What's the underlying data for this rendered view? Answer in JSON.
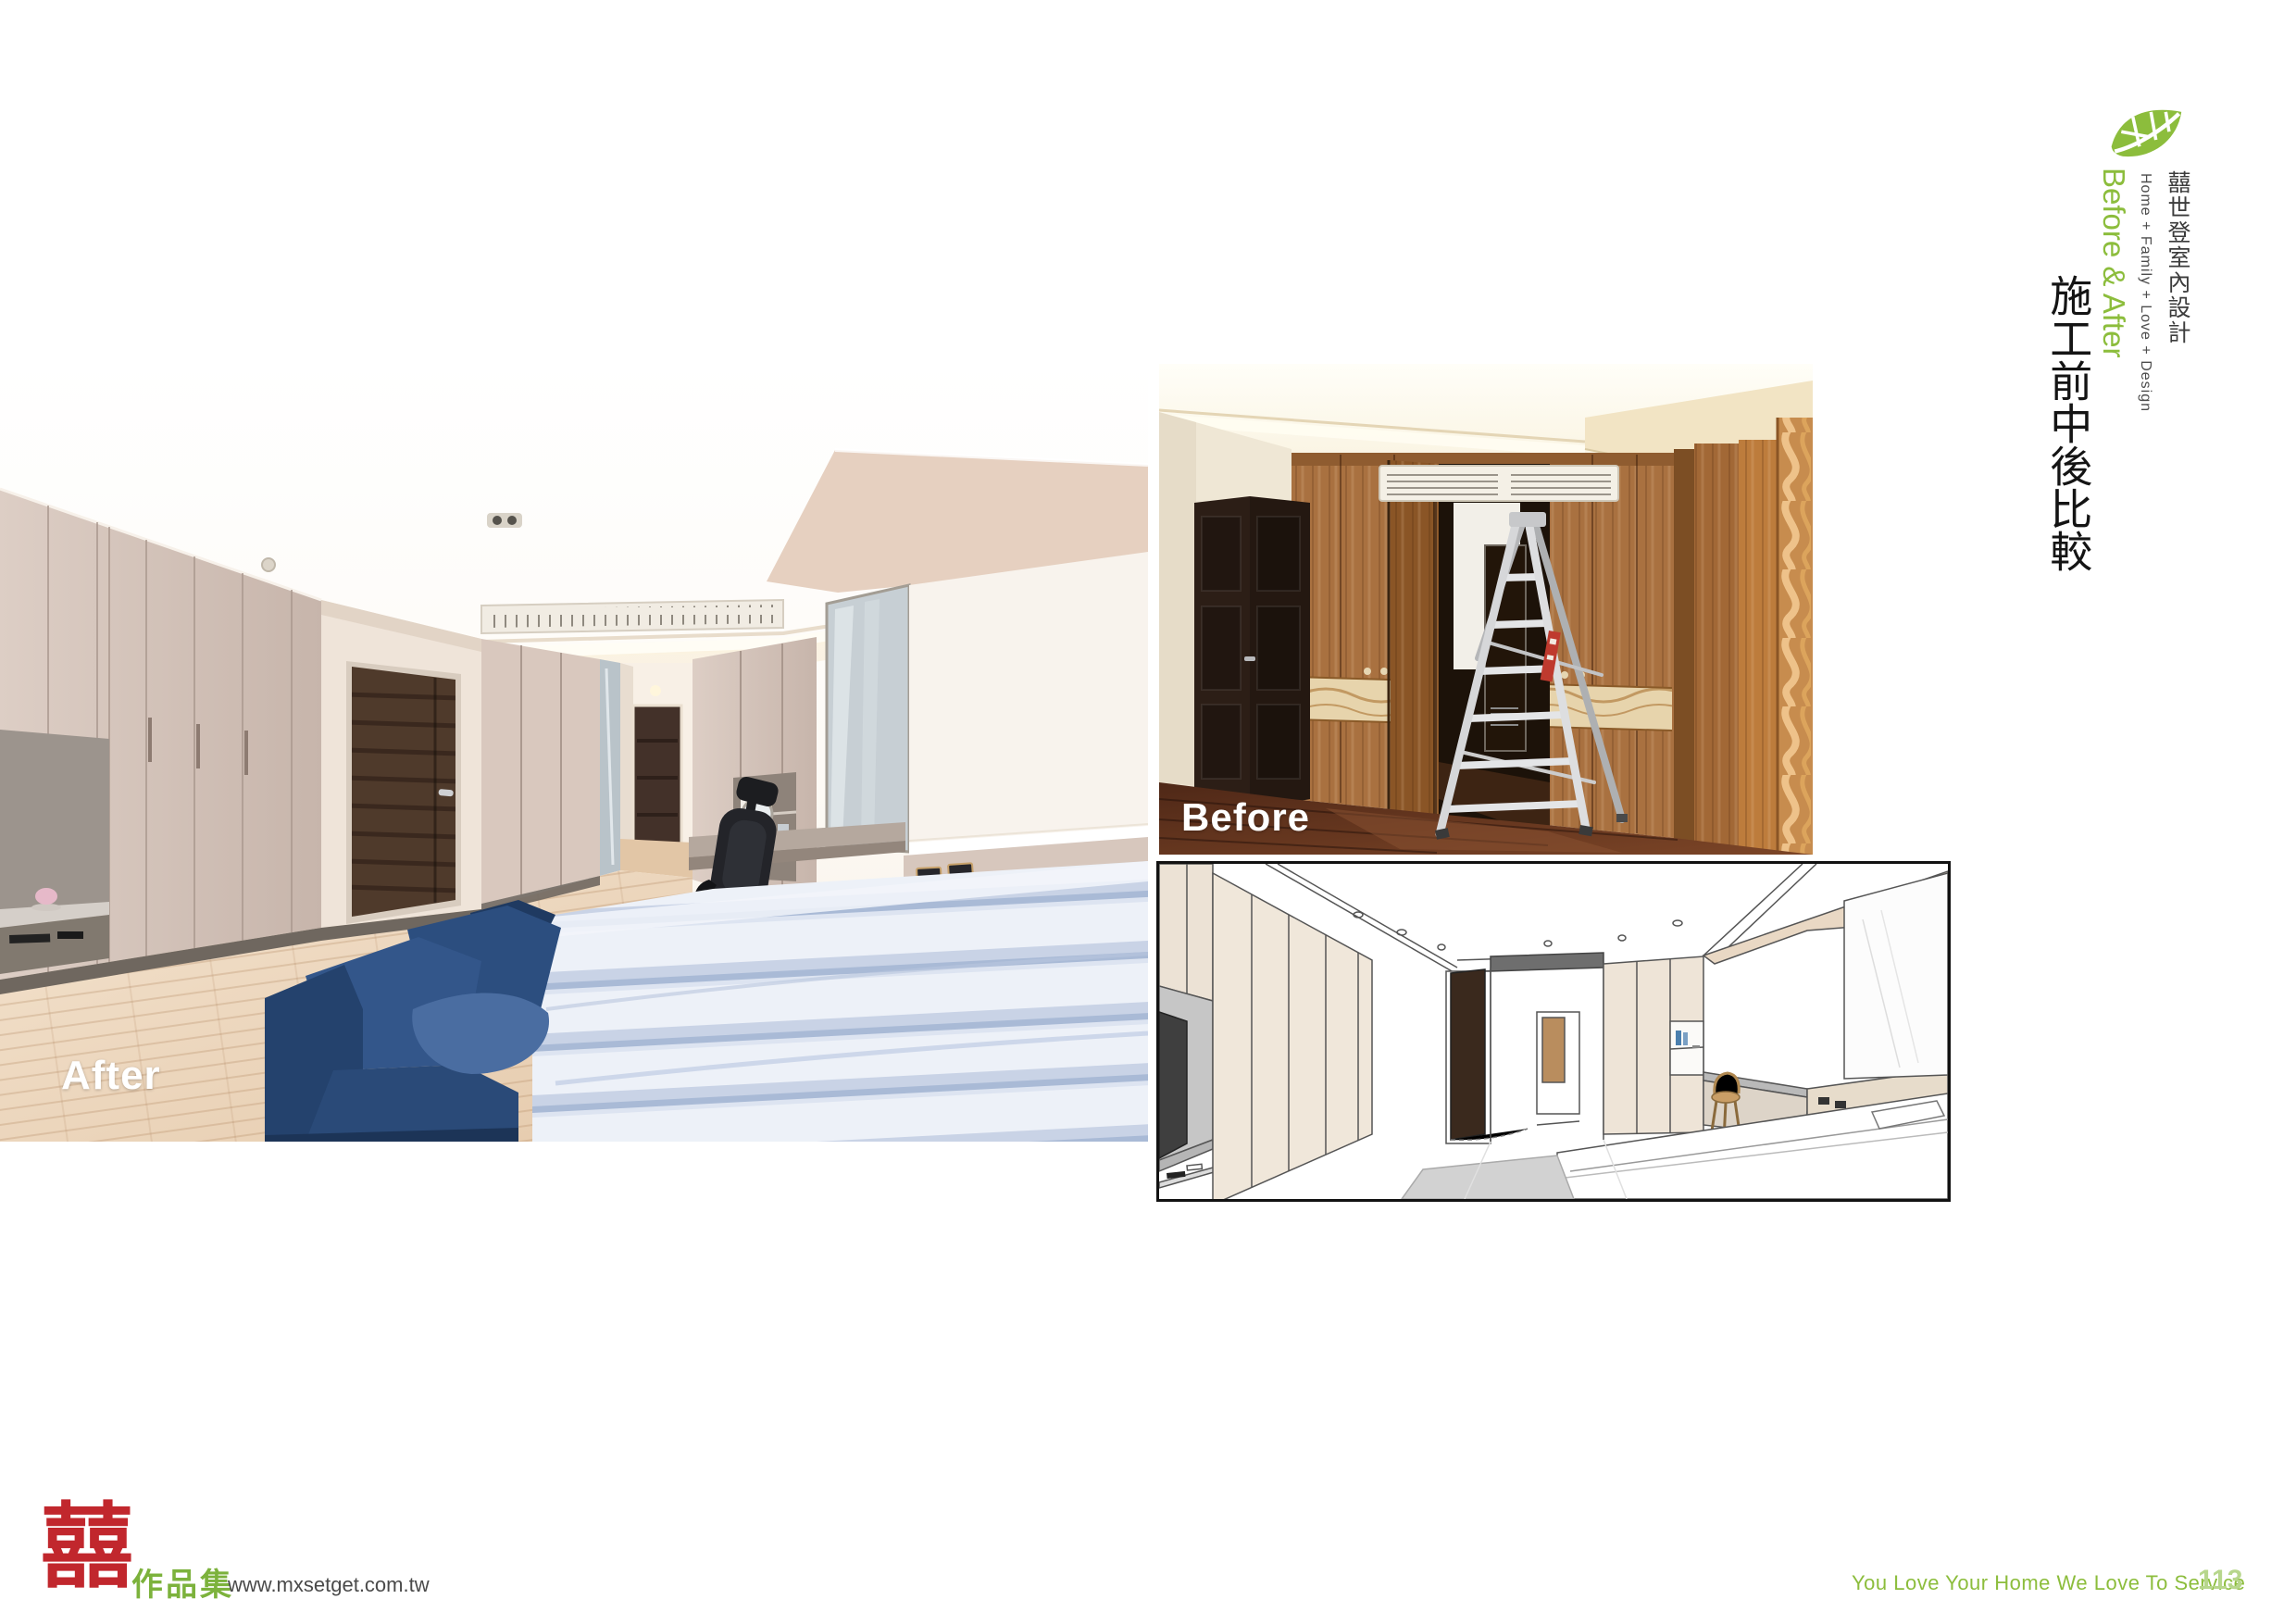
{
  "page": {
    "background": "#ffffff"
  },
  "side_column": {
    "leaf_icon": "leaf-logo",
    "brand_cn": "囍世登室內設計",
    "brand_en": "Home + Family + Love + Design",
    "section_en": "Before & After",
    "section_cn": "施工前中後比較"
  },
  "photos": {
    "after": {
      "label": "After"
    },
    "before": {
      "label": "Before"
    }
  },
  "footer": {
    "logo_character": "囍",
    "logo_caption": "作品集",
    "website": "www.mxsetget.com.tw",
    "slogan": "You Love Your Home We Love To Service",
    "page_number": "113"
  },
  "colors": {
    "accent_green": "#8cbd3c",
    "logo_red": "#c1272d",
    "page_number_green": "#b7d68c"
  }
}
